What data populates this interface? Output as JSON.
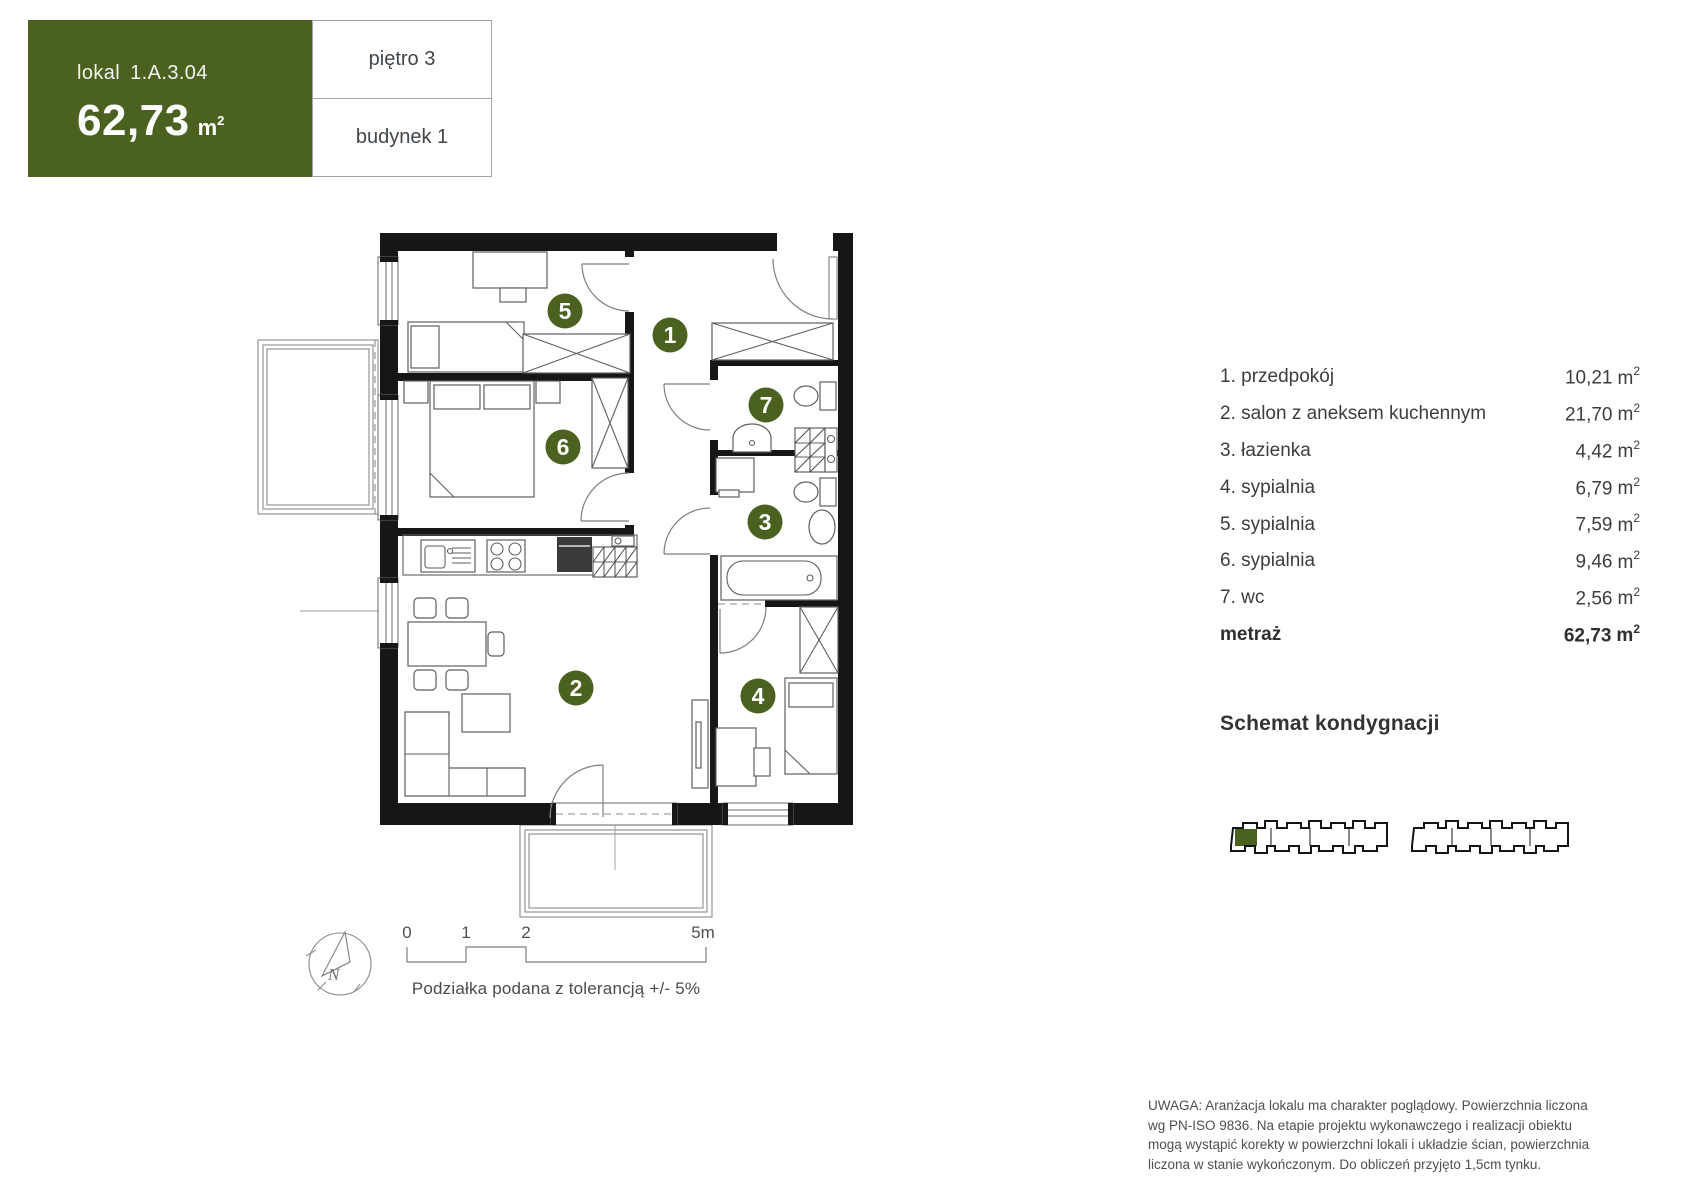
{
  "header": {
    "unit_label": "lokal",
    "unit_number": "1.A.3.04",
    "area_value": "62,73",
    "area_unit": "m",
    "area_unit_sup": "2",
    "floor_label": "piętro 3",
    "building_label": "budynek 1"
  },
  "plan": {
    "markers": [
      {
        "n": "1"
      },
      {
        "n": "2"
      },
      {
        "n": "3"
      },
      {
        "n": "4"
      },
      {
        "n": "5"
      },
      {
        "n": "6"
      },
      {
        "n": "7"
      }
    ]
  },
  "room_list": {
    "rows": [
      {
        "label": "1. przedpokój",
        "value": "10,21"
      },
      {
        "label": "2. salon z aneksem kuchennym",
        "value": "21,70"
      },
      {
        "label": "3. łazienka",
        "value": "4,42"
      },
      {
        "label": "4. sypialnia",
        "value": "6,79"
      },
      {
        "label": "5. sypialnia",
        "value": "7,59"
      },
      {
        "label": "6. sypialnia",
        "value": "9,46"
      },
      {
        "label": "7. wc",
        "value": "2,56"
      }
    ],
    "total_label": "metraż",
    "total_value": "62,73",
    "unit_base": "m",
    "unit_sup": "2"
  },
  "schemat": {
    "heading": "Schemat kondygnacji"
  },
  "scale_bar": {
    "tick0": "0",
    "tick1": "1",
    "tick2": "2",
    "tick5": "5m",
    "caption": "Podziałka podana z tolerancją +/- 5%"
  },
  "compass": {
    "north": "N"
  },
  "disclaimer": {
    "lines": [
      "UWAGA: Aranżacja lokalu ma charakter poglądowy. Powierzchnia liczona",
      "wg PN-ISO 9836. Na etapie projektu wykonawczego i realizacji obiektu",
      "mogą wystąpić korekty w powierzchni lokali i układzie ścian, powierzchnia",
      "liczona w stanie wykończonym. Do obliczeń przyjęto 1,5cm tynku."
    ]
  },
  "colors": {
    "accent_green": "#4a6120",
    "wall_black": "#161616"
  }
}
